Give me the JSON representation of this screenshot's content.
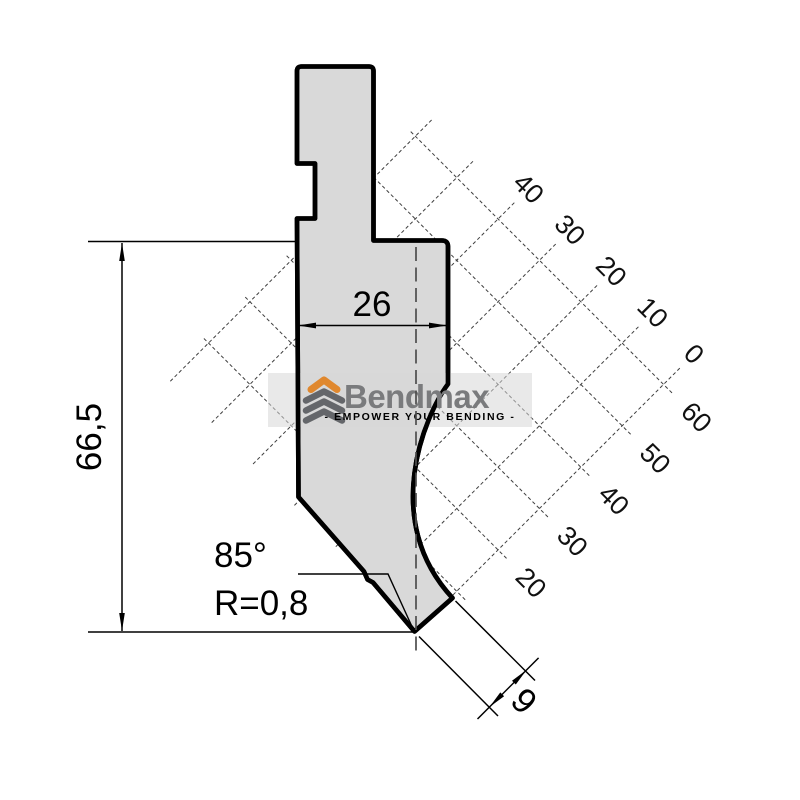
{
  "drawing": {
    "title": "Press brake punch technical drawing",
    "dimensions": {
      "height_label": "66,5",
      "width_label": "26",
      "angle_label": "85°",
      "radius_label": "R=0,8",
      "tip_offset_label": "9"
    },
    "grid": {
      "top_axis_labels": [
        "40",
        "30",
        "20",
        "10",
        "0"
      ],
      "right_axis_labels": [
        "60",
        "50",
        "40",
        "30",
        "20"
      ]
    },
    "watermark": {
      "brand": "Bendmax",
      "tagline": "- EMPOWER YOUR BENDING -"
    },
    "colors": {
      "part_fill": "#d9d9d9",
      "outline": "#000000",
      "brand_gray": "#7a7b7d",
      "brand_orange": "#e0882e",
      "watermark_band": "#dcdcdc"
    }
  }
}
